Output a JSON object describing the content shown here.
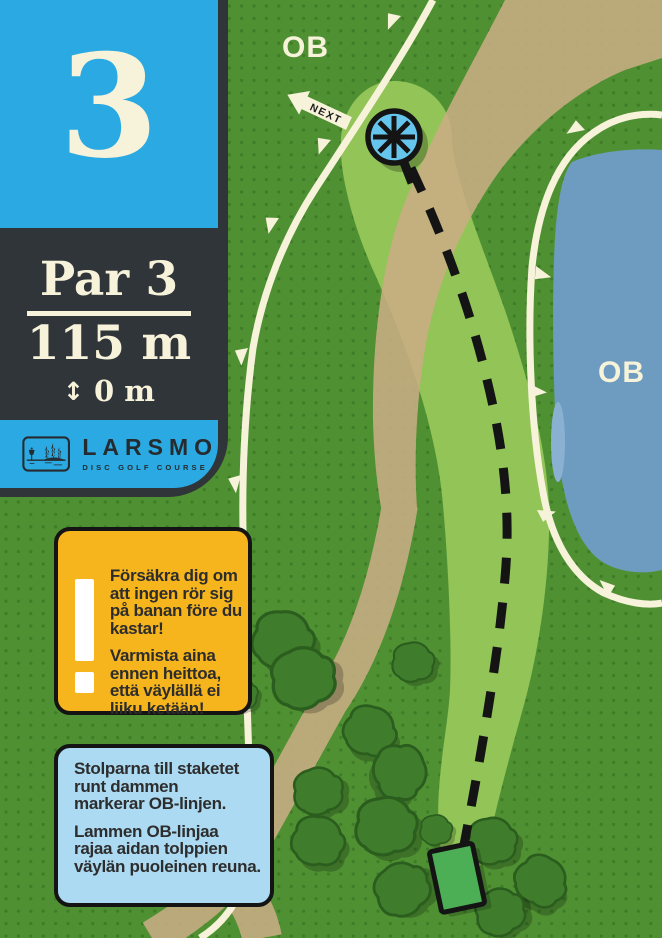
{
  "sidebar": {
    "hole_number": "3",
    "par_label": "Par 3",
    "distance_label": "115 m",
    "elevation_arrow": "↕",
    "elevation_label": "0 m",
    "logo": {
      "name": "LARSMO",
      "subtitle": "DISC GOLF COURSE",
      "icon": "disc-golf-lake-scene"
    }
  },
  "warning_box": {
    "icon": "exclamation-icon",
    "p1": [
      "Försäkra dig om",
      "att ingen rör sig",
      "på banan före du",
      "kastar!"
    ],
    "p2": [
      "Varmista aina",
      "ennen heittoa,",
      "että väylällä ei",
      "liiku ketään!"
    ]
  },
  "info_box": {
    "p1": [
      "Stolparna till staketet",
      "runt dammen",
      "markerar OB-linjen."
    ],
    "p2": [
      "Lammen OB-linjaa",
      "rajaa aidan tolppien",
      "väylän puoleinen reuna."
    ]
  },
  "map": {
    "ob_label_top": "OB",
    "ob_label_pond": "OB",
    "next_sign_label": "NEXT",
    "colors": {
      "grass": "#4f9132",
      "grass_dot": "#3e7c27",
      "fairway": "#92c457",
      "path_tan": "#c9ad84",
      "water": "#6d9cc0",
      "water_shallow": "#8ab1d2",
      "fence_cream": "#f7f2da",
      "panel_blue": "#2aa9e2",
      "panel_dark": "#30353a",
      "warning_yellow": "#f6b41d",
      "info_blue": "#abdaf2",
      "tee_green": "#4caf55",
      "basket_blue": "#66c5ec",
      "bush_green": "#3f7d2c",
      "line_black": "#141414"
    }
  }
}
